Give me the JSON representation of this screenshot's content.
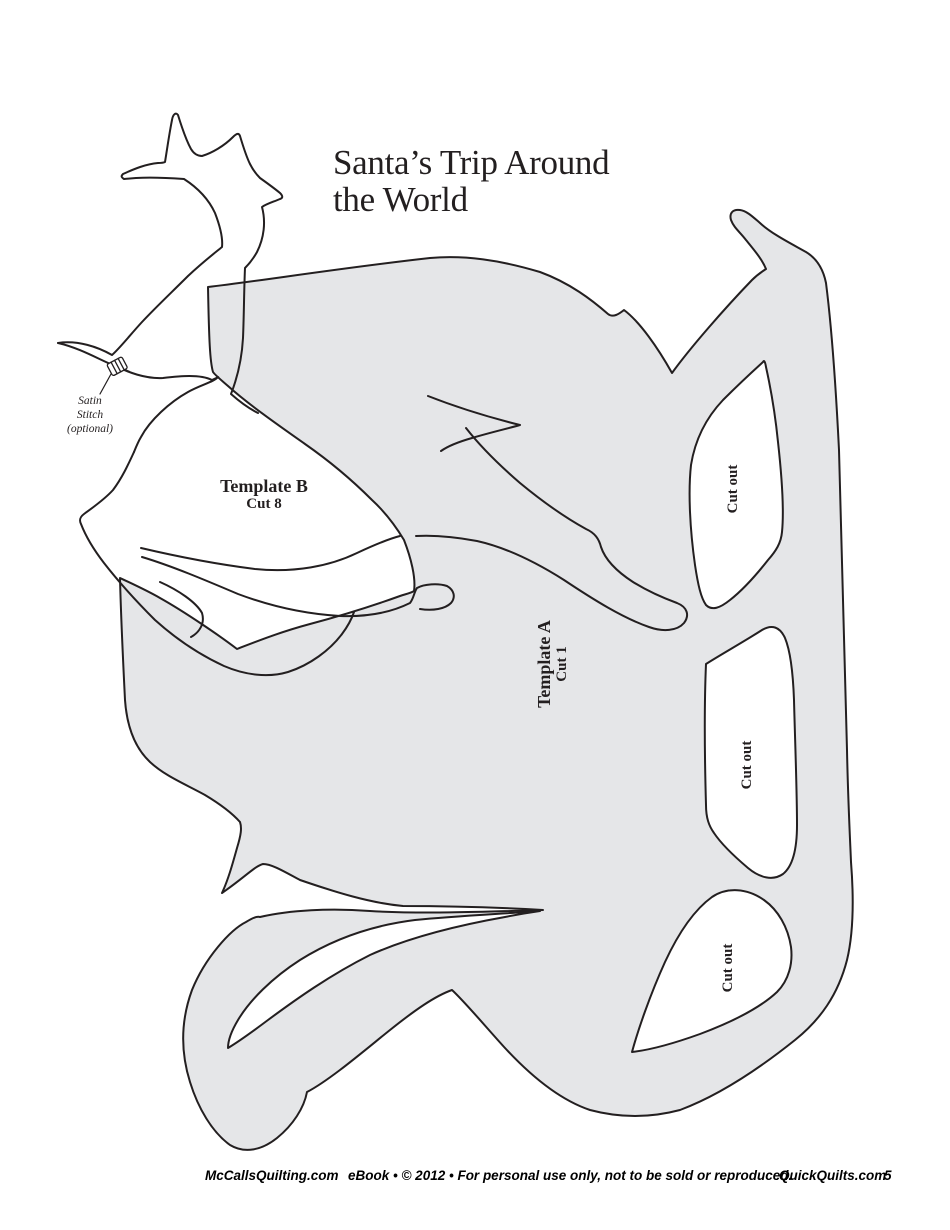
{
  "page": {
    "title_line1": "Santa’s Trip Around",
    "title_line2": "the World"
  },
  "labels": {
    "template_b": {
      "title": "Template B",
      "cut": "Cut 8"
    },
    "template_a": {
      "title": "Template A",
      "cut": "Cut 1"
    },
    "satin": {
      "line1": "Satin",
      "line2": "Stitch",
      "line3": "(optional)"
    },
    "cutouts": [
      {
        "label": "Cut out"
      },
      {
        "label": "Cut out"
      },
      {
        "label": "Cut out"
      }
    ]
  },
  "footer": {
    "left": "McCallsQuilting.com",
    "center": "eBook • © 2012 • For personal use only, not to be sold or reproduced.",
    "right": "QuickQuilts.com",
    "page_number": "5"
  },
  "colors": {
    "template_fill": "#e5e6e8",
    "line": "#231f20",
    "background": "#ffffff"
  }
}
